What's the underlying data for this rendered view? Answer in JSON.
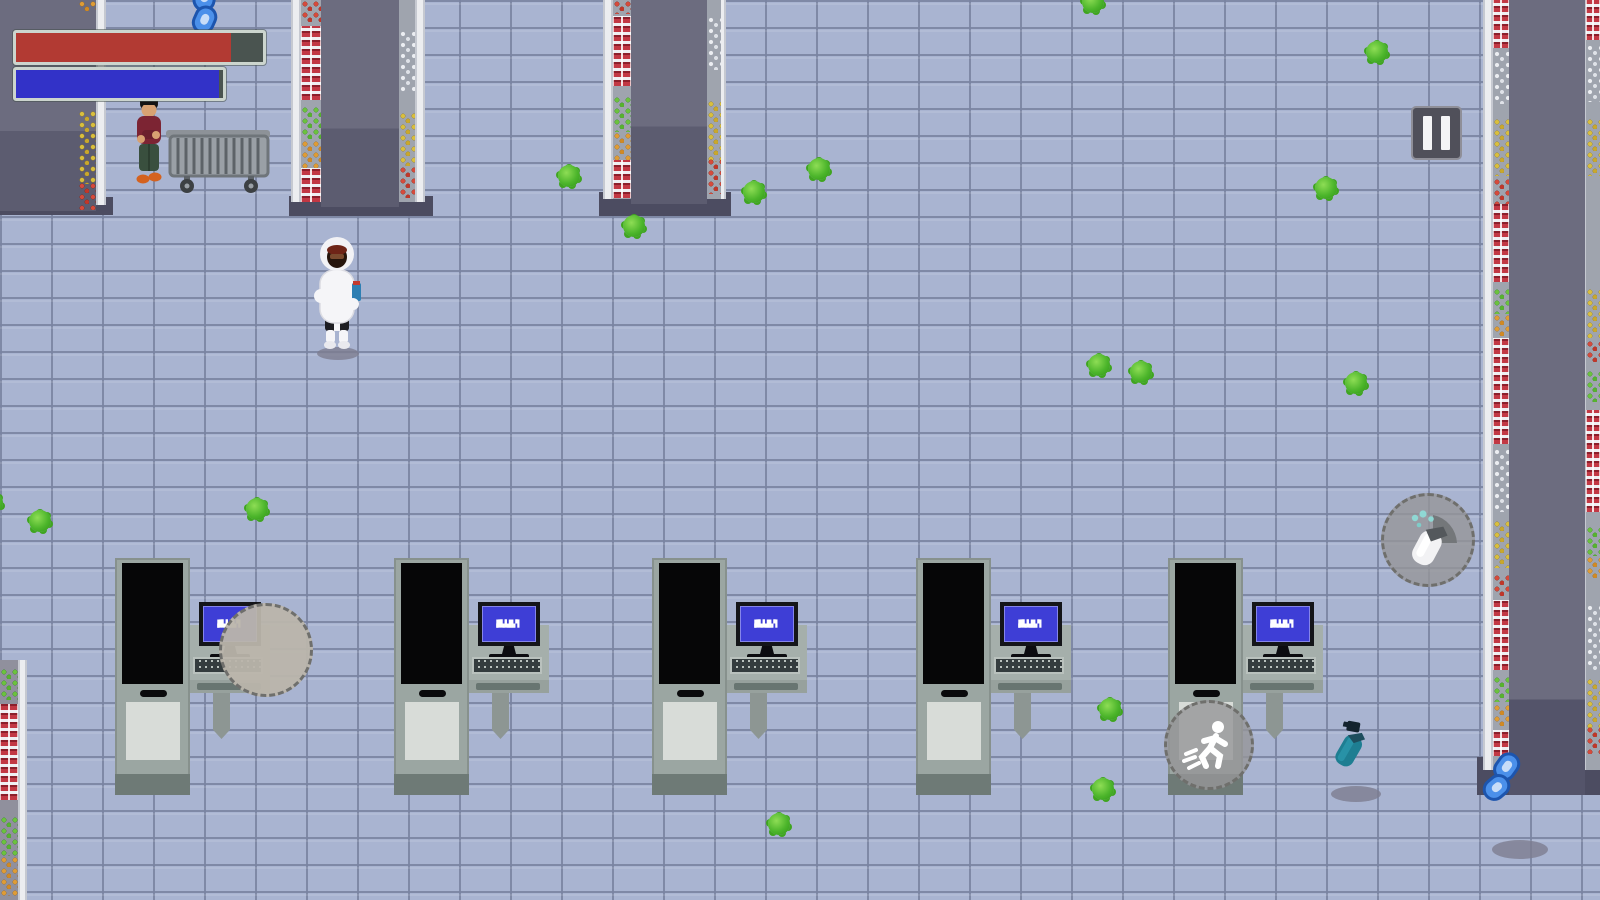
{
  "hud": {
    "health_bar": {
      "percent": 87,
      "fill": "#b23a33",
      "track": "#4a5450",
      "border": "#ccd5ce",
      "x": 13,
      "y": 30,
      "w": 247,
      "h": 29
    },
    "stamina_bar": {
      "percent": 98,
      "fill": "#3232c8",
      "track": "#4a5450",
      "border": "#ccd5ce",
      "x": 13,
      "y": 67,
      "w": 207,
      "h": 28
    },
    "pause": {
      "x": 1411,
      "y": 106,
      "w": 51,
      "h": 54,
      "icon": "pause-icon"
    }
  },
  "action_buttons": [
    {
      "id": "disinfect",
      "icon": "spray-bottle-icon",
      "x": 1428,
      "y": 540,
      "r": 47
    },
    {
      "id": "sprint",
      "icon": "running-man-icon",
      "x": 1209,
      "y": 745,
      "r": 45
    },
    {
      "id": "extra",
      "icon": "",
      "x": 266,
      "y": 650,
      "r": 47
    }
  ],
  "checkouts": {
    "xs": [
      115,
      394,
      652,
      916,
      1168
    ],
    "y": 547,
    "monitor_text": [
      "▛▚▙▜▞▖",
      "▟▙▚▛▞▘"
    ]
  },
  "viruses": [
    [
      1093,
      2
    ],
    [
      1377,
      52
    ],
    [
      569,
      176
    ],
    [
      819,
      169
    ],
    [
      754,
      192
    ],
    [
      634,
      226
    ],
    [
      1326,
      188
    ],
    [
      1099,
      365
    ],
    [
      1141,
      372
    ],
    [
      1356,
      383
    ],
    [
      257,
      509
    ],
    [
      40,
      521
    ],
    [
      -8,
      503
    ],
    [
      1110,
      709
    ],
    [
      1103,
      789
    ],
    [
      779,
      824
    ]
  ],
  "shadows": [
    [
      338,
      353,
      42,
      13
    ],
    [
      1356,
      794,
      50,
      16
    ],
    [
      1520,
      849,
      56,
      19
    ]
  ],
  "items": [
    {
      "type": "spray-bottle",
      "x": 1332,
      "y": 718,
      "rot": 30
    },
    {
      "type": "chain-link",
      "x": 1483,
      "y": 752,
      "rot": 36
    },
    {
      "type": "chain-link",
      "x": 188,
      "y": -18,
      "rot": 10
    }
  ],
  "player": {
    "x": 312,
    "y": 226
  },
  "npc": {
    "x": 130,
    "y": 94
  },
  "cart": {
    "x": 164,
    "y": 122
  },
  "colors": {
    "floor": "#a9b4d1",
    "virus_green": "#4cb52b",
    "health_red": "#b23a33",
    "stamina_blue": "#3232c8",
    "monitor_blue": "#3e3ed6"
  },
  "shelves": [
    {
      "id": "wall-left",
      "rects": [
        {
          "c": "shelf-base",
          "x": 0,
          "y": 197,
          "w": 113,
          "h": 18
        },
        {
          "c": "shelf-top",
          "x": 0,
          "y": 0,
          "w": 96,
          "h": 211
        },
        {
          "c": "shelf-strip",
          "x": 96,
          "y": 0,
          "w": 10,
          "h": 205
        }
      ],
      "lanes": [
        {
          "x": 78,
          "y": 0,
          "w": 18,
          "h": 211,
          "bg": "transparent",
          "segs": [
            [
              0,
              11,
              "orange"
            ],
            [
              110,
              74,
              "yellow"
            ],
            [
              182,
              28,
              "red"
            ]
          ]
        }
      ]
    },
    {
      "id": "aisle-left",
      "rects": [
        {
          "c": "shelf-base",
          "x": 289,
          "y": 196,
          "w": 144,
          "h": 20
        },
        {
          "c": "shelf-strip",
          "x": 291,
          "y": 0,
          "w": 10,
          "h": 202
        },
        {
          "c": "shelf-strip",
          "x": 415,
          "y": 0,
          "w": 10,
          "h": 202
        },
        {
          "c": "shelf-top",
          "x": 321,
          "y": 0,
          "w": 78,
          "h": 207
        }
      ],
      "lanes": [
        {
          "x": 301,
          "y": 0,
          "w": 20,
          "h": 202,
          "segs": [
            [
              0,
              22,
              "red"
            ],
            [
              26,
              74,
              "cans"
            ],
            [
              106,
              34,
              "green"
            ],
            [
              140,
              28,
              "orange"
            ],
            [
              168,
              34,
              "cans"
            ]
          ]
        },
        {
          "x": 399,
          "y": 0,
          "w": 16,
          "h": 202,
          "segs": [
            [
              30,
              62,
              "bottles"
            ],
            [
              112,
              54,
              "yellow"
            ],
            [
              166,
              32,
              "red"
            ]
          ]
        }
      ]
    },
    {
      "id": "aisle-mid",
      "rects": [
        {
          "c": "shelf-base",
          "x": 599,
          "y": 192,
          "w": 132,
          "h": 24
        },
        {
          "c": "shelf-strip",
          "x": 603,
          "y": 0,
          "w": 10,
          "h": 199
        },
        {
          "c": "shelf-strip",
          "x": 717,
          "y": 0,
          "w": 9,
          "h": 199
        },
        {
          "c": "shelf-top",
          "x": 631,
          "y": 0,
          "w": 76,
          "h": 204
        }
      ],
      "lanes": [
        {
          "x": 613,
          "y": 0,
          "w": 18,
          "h": 199,
          "segs": [
            [
              0,
              14,
              "red"
            ],
            [
              16,
              70,
              "cans"
            ],
            [
              96,
              36,
              "green"
            ],
            [
              132,
              28,
              "orange"
            ],
            [
              160,
              38,
              "cans"
            ]
          ]
        },
        {
          "x": 707,
          "y": 0,
          "w": 14,
          "h": 199,
          "segs": [
            [
              16,
              54,
              "bottles"
            ],
            [
              100,
              62,
              "yellow"
            ],
            [
              158,
              36,
              "red"
            ]
          ]
        }
      ]
    },
    {
      "id": "wall-right",
      "rects": [
        {
          "c": "shelf-base",
          "x": 1477,
          "y": 757,
          "w": 123,
          "h": 38
        },
        {
          "c": "shelf-strip",
          "x": 1483,
          "y": 0,
          "w": 10,
          "h": 770
        },
        {
          "c": "shelf-top tall",
          "x": 1509,
          "y": 0,
          "w": 76,
          "h": 795
        },
        {
          "c": "shelf-strip",
          "x": 1585,
          "y": 0,
          "w": 8,
          "h": 770
        }
      ],
      "lanes": [
        {
          "x": 1493,
          "y": 0,
          "w": 16,
          "h": 770,
          "segs": [
            [
              0,
              48,
              "cans"
            ],
            [
              50,
              54,
              "bottles"
            ],
            [
              118,
              58,
              "yellow"
            ],
            [
              178,
              26,
              "red"
            ],
            [
              204,
              78,
              "cans"
            ],
            [
              288,
              26,
              "green"
            ],
            [
              314,
              22,
              "orange"
            ],
            [
              338,
              106,
              "cans"
            ],
            [
              448,
              64,
              "bottles"
            ],
            [
              520,
              48,
              "yellow"
            ],
            [
              574,
              22,
              "red"
            ],
            [
              600,
              70,
              "cans"
            ],
            [
              676,
              26,
              "green"
            ],
            [
              704,
              22,
              "orange"
            ],
            [
              730,
              26,
              "cans"
            ]
          ]
        },
        {
          "x": 1586,
          "y": 0,
          "w": 14,
          "h": 770,
          "segs": [
            [
              0,
              40,
              "cans"
            ],
            [
              44,
              58,
              "bottles"
            ],
            [
              118,
              58,
              "yellow"
            ],
            [
              288,
              50,
              "yellow"
            ],
            [
              340,
              22,
              "red"
            ],
            [
              370,
              32,
              "green"
            ],
            [
              410,
              102,
              "cans"
            ],
            [
              526,
              30,
              "green"
            ],
            [
              556,
              22,
              "orange"
            ],
            [
              604,
              66,
              "bottles"
            ],
            [
              678,
              50,
              "yellow"
            ],
            [
              726,
              28,
              "red"
            ]
          ]
        }
      ]
    },
    {
      "id": "wall-bottom-left",
      "rects": [
        {
          "c": "shelf-strip",
          "x": 18,
          "y": 660,
          "w": 9,
          "h": 240
        }
      ],
      "lanes": [
        {
          "x": 0,
          "y": 660,
          "w": 18,
          "h": 240,
          "bg": "#90909d",
          "segs": [
            [
              8,
              32,
              "green"
            ],
            [
              44,
              96,
              "cans"
            ],
            [
              156,
              40,
              "green"
            ],
            [
              196,
              40,
              "orange"
            ]
          ]
        }
      ]
    }
  ]
}
